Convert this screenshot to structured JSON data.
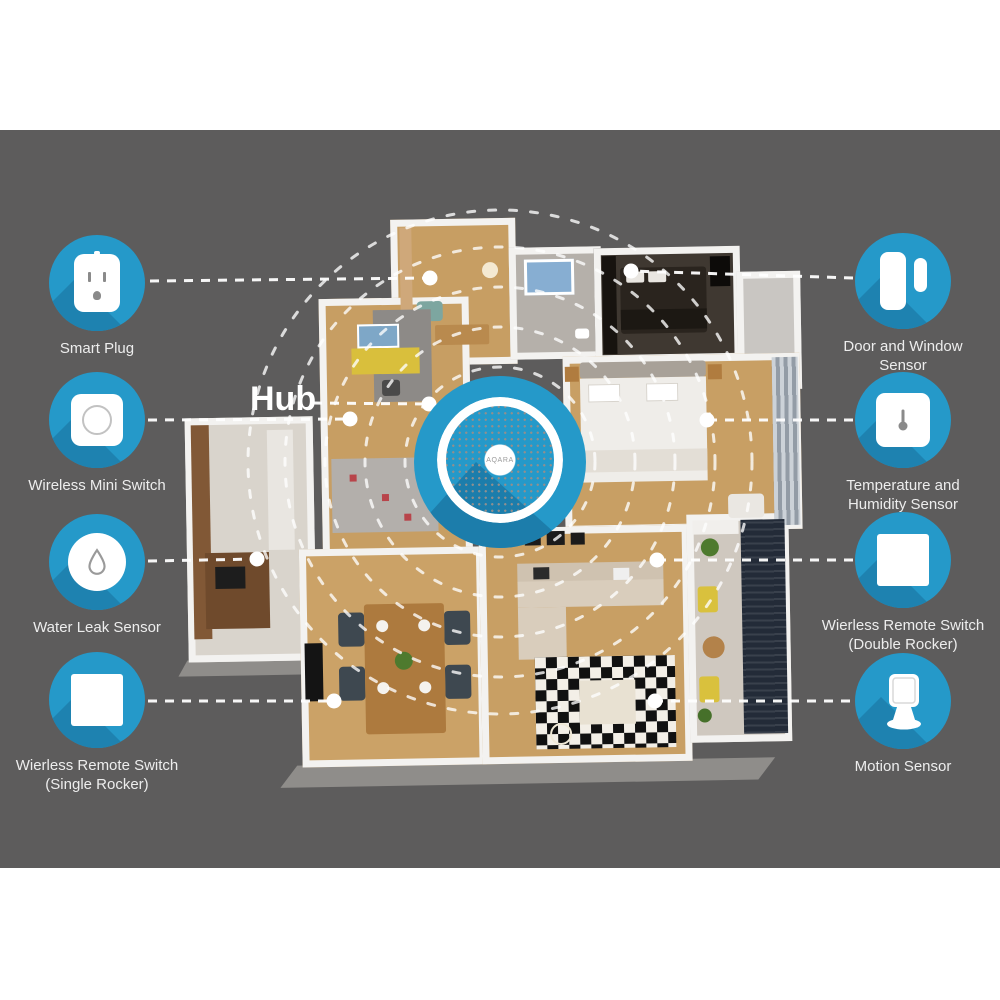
{
  "hub": {
    "label": "Hub",
    "device_text": "AQARA"
  },
  "devices": [
    {
      "id": "smart-plug",
      "line1": "Smart Plug",
      "line2": "",
      "icon": "smart-plug-icon"
    },
    {
      "id": "wireless-mini-switch",
      "line1": "Wireless Mini Switch",
      "line2": "",
      "icon": "round-button-icon"
    },
    {
      "id": "water-leak-sensor",
      "line1": "Water Leak Sensor",
      "line2": "",
      "icon": "water-drop-icon"
    },
    {
      "id": "wierless-remote-switch-single",
      "line1": "Wierless Remote Switch",
      "line2": "(Single Rocker)",
      "icon": "square-rocker-icon"
    },
    {
      "id": "door-and-window-sensor",
      "line1": "Door and Window",
      "line2": "Sensor",
      "icon": "door-window-icon"
    },
    {
      "id": "temperature-humidity-sensor",
      "line1": "Temperature and",
      "line2": "Humidity Sensor",
      "icon": "thermometer-icon"
    },
    {
      "id": "wierless-remote-switch-double",
      "line1": "Wierless Remote Switch",
      "line2": "(Double Rocker)",
      "icon": "square-rocker-icon"
    },
    {
      "id": "motion-sensor",
      "line1": "Motion Sensor",
      "line2": "",
      "icon": "motion-sensor-icon"
    }
  ],
  "colors": {
    "panel_gray": "#5d5c5c",
    "device_blue": "#2599c9",
    "long_shadow_blue": "#1e82b0",
    "connector_white": "#ffffff"
  }
}
